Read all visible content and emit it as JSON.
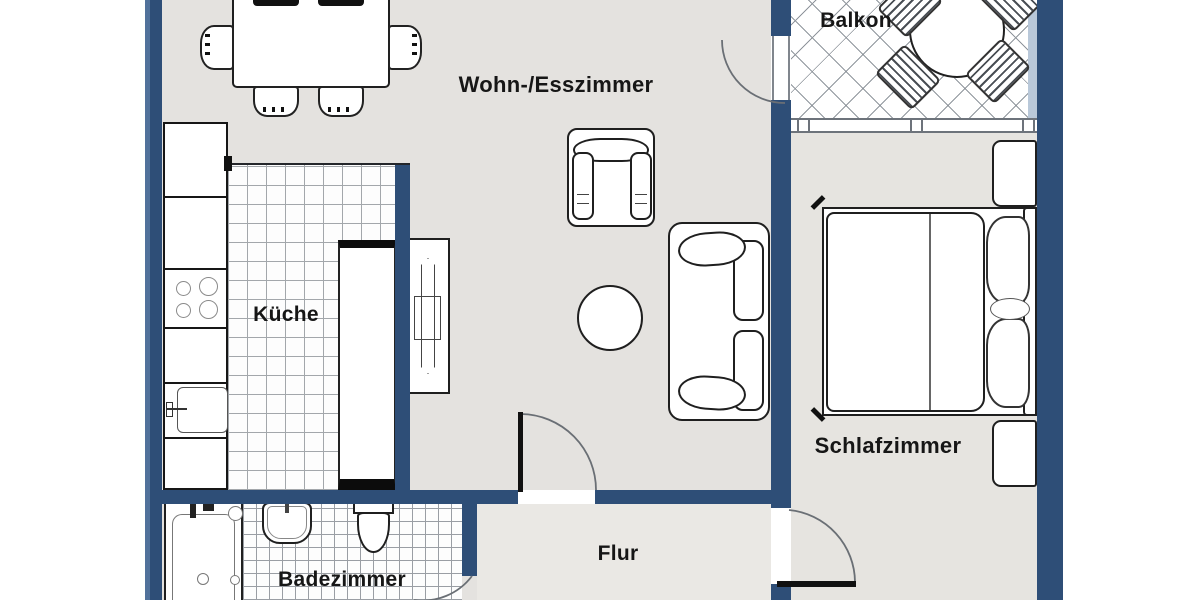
{
  "rooms": [
    {
      "id": "wohn-esszimmer",
      "label": "Wohn-/Esszimmer"
    },
    {
      "id": "balkon",
      "label": "Balkon"
    },
    {
      "id": "kueche",
      "label": "Küche"
    },
    {
      "id": "schlafzimmer",
      "label": "Schlafzimmer"
    },
    {
      "id": "badezimmer",
      "label": "Badezimmer"
    },
    {
      "id": "flur",
      "label": "Flur"
    }
  ],
  "colors": {
    "wall": "#2e4e77",
    "floor": "#e4e2df",
    "hall_floor": "#eae8e4",
    "furniture_outline": "#1f1f1f",
    "tile_line": "#a3a7ab",
    "window_frame": "#6d737b"
  },
  "furniture_icons": [
    "dining-table",
    "dining-chair",
    "armchair",
    "coffee-table",
    "sofa",
    "tv-sideboard",
    "kitchen-counter",
    "stove-burners",
    "kitchen-sink",
    "tall-cabinet",
    "balcony-round-table",
    "balcony-chair",
    "double-bed",
    "pillow",
    "nightstand",
    "bathtub",
    "washbasin",
    "toilet",
    "door-swing-arc",
    "window-band"
  ]
}
